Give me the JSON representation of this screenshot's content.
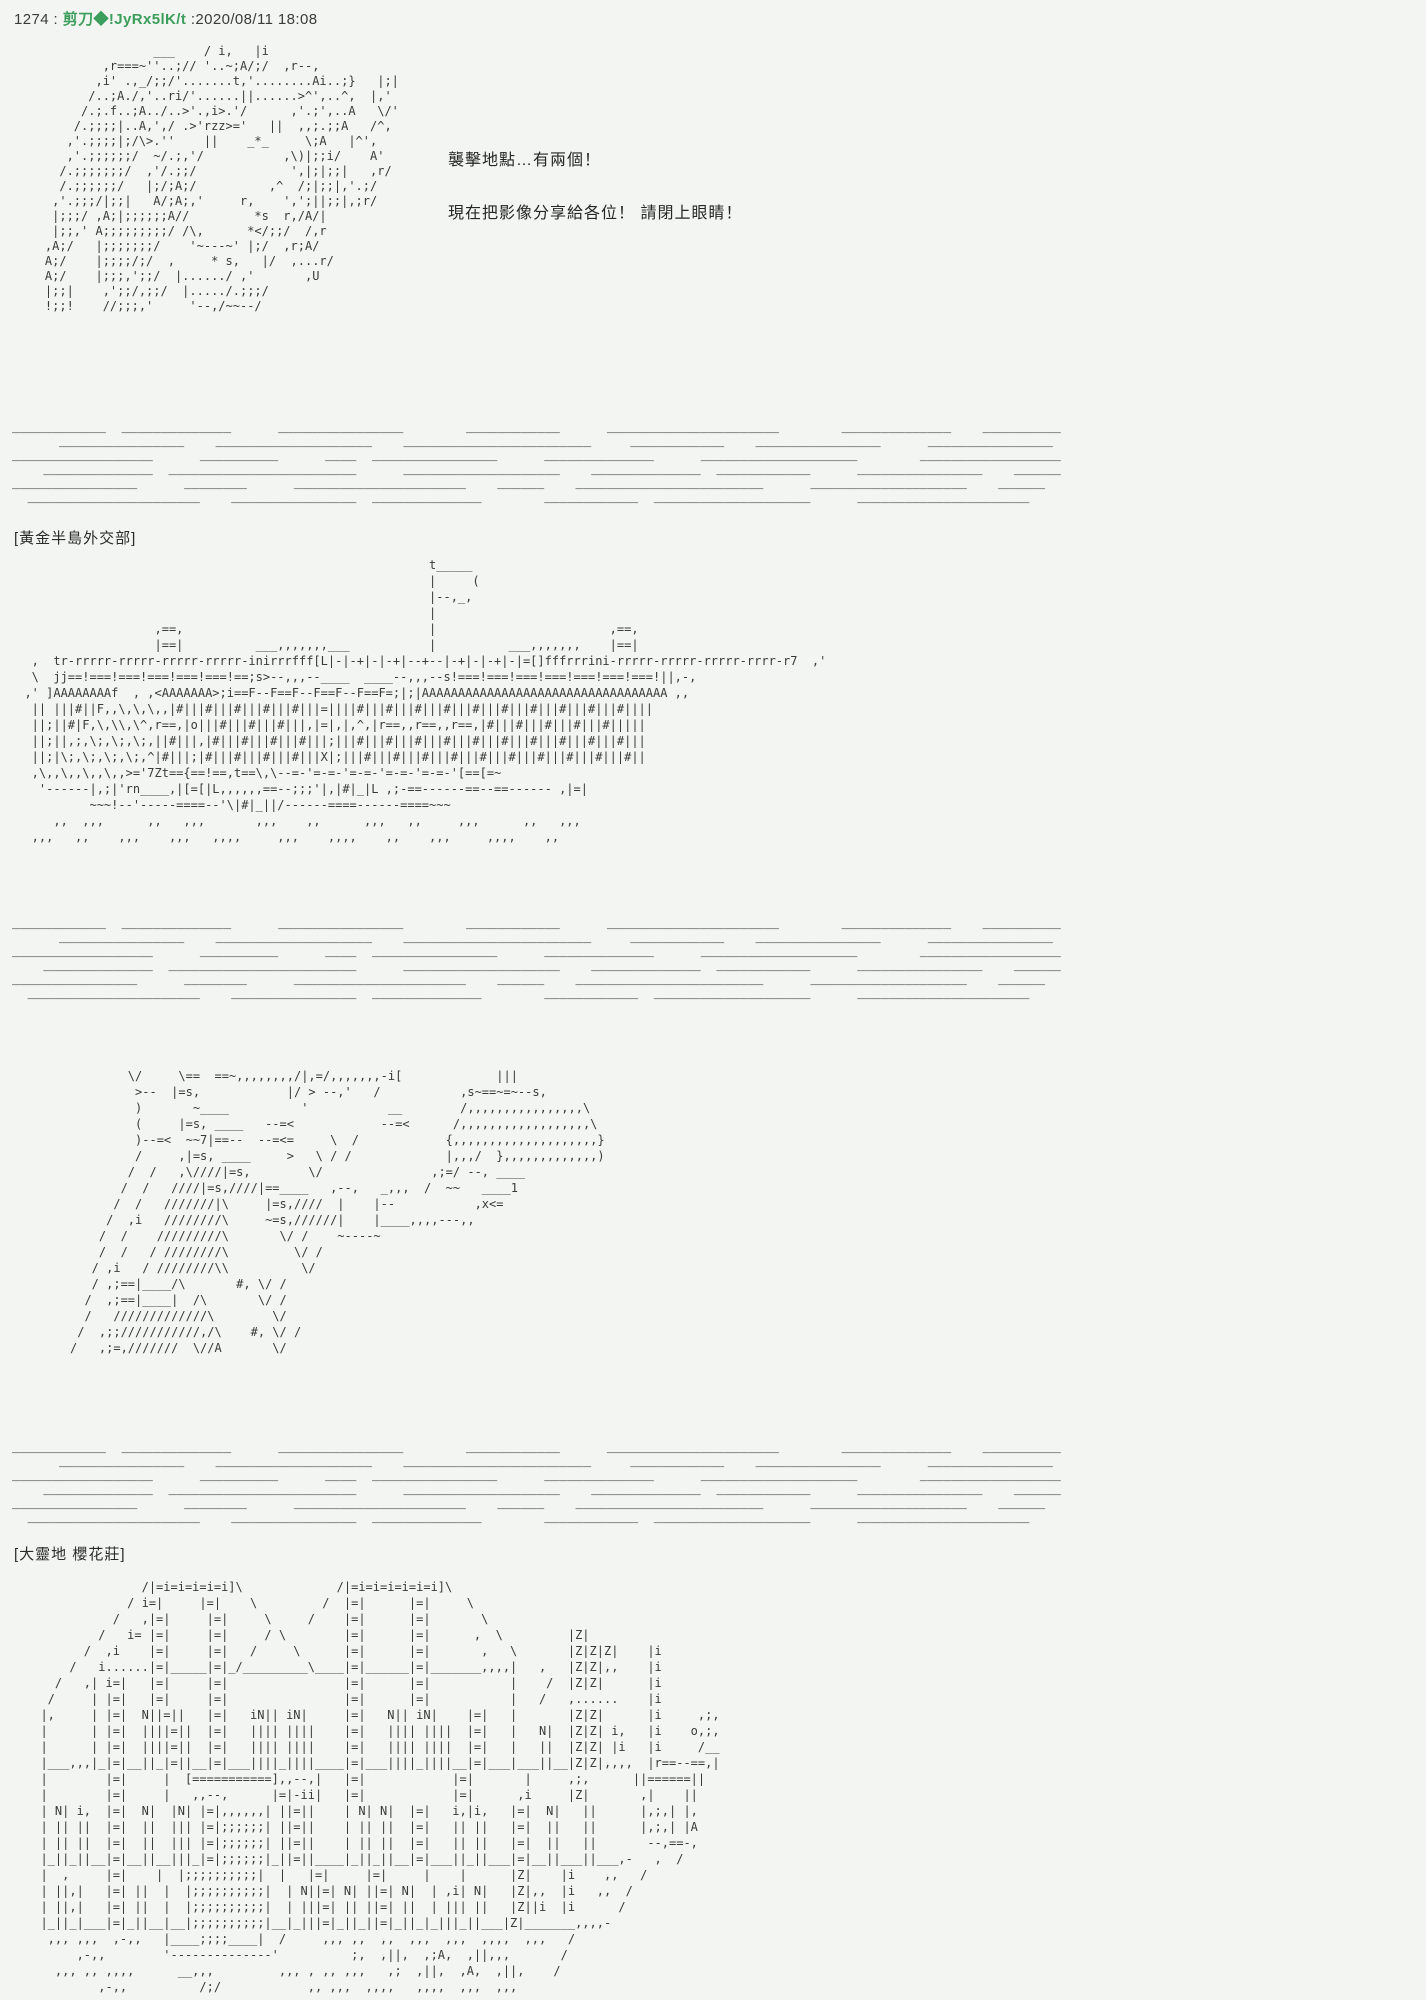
{
  "page": {
    "background_color": "#f2f5f1",
    "aa_text_color": "#3a3a3a",
    "poster_name_color": "#3c9e5d"
  },
  "post": {
    "number": "1274",
    "sep1": " : ",
    "name": "剪刀◆!JyRx5lK/t",
    "sep2": " :",
    "datetime": "2020/08/11 18:08"
  },
  "dialogue": {
    "line1": "襲擊地點…有兩個！",
    "line2": "現在把影像分享給各位！ 請閉上眼睛！"
  },
  "sections": {
    "label1": "[黃金半島外交部]",
    "label2": "[大靈地 櫻花莊]"
  },
  "aa": {
    "character1": [
      "                   ___    / i,   |i",
      "            ,r===~''..;// '..~;A/;/  ,r--,",
      "           ,i' .,_/;;/'.......t,'........Ai..;}   |;|",
      "          /..;A./,'..ri/'......||......>^',..^,  |,'",
      "         /.;.f..;A../..>'.,i>.'/      ,'.;',..A   \\/'",
      "        /.;;;;|..A,',/ .>'rzz>='   ||  ,,;.;;A   /^,",
      "       ,'.;;;;|;/\\>.''    ||    _*_     \\;A   |^',",
      "       ,'.;;;;;;/  ~/.;,'/           ,\\)|;;i/    A'",
      "      /.;;;;;;;/  ,'/.;;/             ',|;|;;|   ,r/",
      "      /.;;;;;;/   |;/;A;/          ,^  /;|;;|,'.;/",
      "     ,'.;;;/|;;|   A/;A;,'     r,    ',';||;;|,;r/",
      "     |;;;/ ,A;|;;;;;;A//         *s  r,/A/|",
      "     |;;,' A;;;;;;;;;/ /\\,      *</;;/  /,r",
      "    ,A;/   |;;;;;;;/    '~---~' |;/  ,r;A/",
      "    A;/    |;;;;/;/  ,     * s,   |/  ,...r/",
      "    A;/    |;;;,';;/  |....../ ,'       ,U",
      "    |;;|    ,';;/,;;/  |...../.;;;/",
      "    !;;!    //;;;,'     '--,/~~--/"
    ],
    "divider": [
      "____________  ______________      ________________        ____________      ______________________        ______________    __________",
      "      ________________    ____________________    ________________________     ____________    ________________      ________________",
      "__________________      __________      ____  ________________      ______________      ____________________        __________________",
      "    ______________  ________________________      ____________________    ______________  ____________      ________________    ______",
      "________________      ________      ______________________    ______    ________________________      ____________________    ______",
      "  ______________________    ________________  ______________        ____________  ____________________      ______________________"
    ],
    "building1": [
      "                                                          t_____",
      "                                                          |     (",
      "                                                          |--,_,",
      "                                                          |",
      "                    ,==,                                  |                        ,==,",
      "                    |==|          ___,,,,,,,___           |          ___,,,,,,,    |==|",
      "   ,  tr-rrrrr-rrrrr-rrrrr-rrrrr-inirrrfff[L|-|-+|-|-+|--+--|-+|-|-+|-|=[]fffrrrini-rrrrr-rrrrr-rrrrr-rrrr-r7  ,'",
      "   \\  jj==!===!===!===!===!===!==;s>--,,,--____  ____--,,,--s!===!===!===!===!===!===!===!||,-,",
      "  ,' ]AAAAAAAAf  , ,<AAAAAAA>;i==F--F==F--F==F--F==F=;|;|AAAAAAAAAAAAAAAAAAAAAAAAAAAAAAAAAA ,,",
      "   || |||#||F,,\\,\\,\\,,|#|||#|||#|||#|||#|||=||||#|||#|||#|||#|||#|||#|||#|||#|||#|||#||||",
      "   ||;||#|F,\\,\\\\,\\^,r==,|o|||#|||#|||#|||,|=|,|,^,|r==,,r==,,r==,|#|||#|||#|||#|||#|||||",
      "   ||;||,;,\\;,\\;,\\;,||#|||,|#|||#|||#|||#|||;|||#|||#|||#|||#|||#|||#|||#|||#|||#|||#|||",
      "   ||;|\\;,\\;,\\;,\\;,^|#|||;|#|||#|||#|||#|||X|;|||#|||#|||#|||#|||#|||#|||#|||#|||#|||#||",
      "   ,\\,,\\,,\\,,\\,,>='7Zt=={==!==,t==\\,\\--=-'=-=-'=-=-'=-=-'=-=-'[==[=~",
      "    '------|,;|'rn____,|[=[|L,,,,,,==--;;;'|,|#|_|L ,;-==------==--==------ ,|=|",
      "           ~~~!--'-----====--'\\|#|_||/------====------====~~~",
      "      ,,  ,,,      ,,   ,,,       ,,,    ,,      ,,,   ,,     ,,,      ,,   ,,,",
      "   ,,,   ,,    ,,,    ,,,   ,,,,     ,,,    ,,,,    ,,    ,,,     ,,,,    ,,"
    ],
    "character2": [
      "        \\/     \\==  ==~,,,,,,,,/|,=/,,,,,,,-i[             |||",
      "         >--  |=s,            |/ > --,'   /           ,s~==~=~--s,",
      "         )       ~____          '           __        /,,,,,,,,,,,,,,,,\\",
      "         (     |=s, ____   --=<            --=<      /,,,,,,,,,,,,,,,,,,\\",
      "         )--=<  ~~7|==--  --=<=     \\  /            {,,,,,,,,,,,,,,,,,,,,}",
      "         /     ,|=s, ____     >   \\ / /             |,,,/  },,,,,,,,,,,,,)",
      "        /  /   ,\\////|=s,        \\/               ,;=/ --, ____",
      "       /  /   ////|=s,////|==____   ,--,   _,,,  /  ~~   ____1",
      "      /  /   ///////|\\     |=s,////  |    |--           ,x<=",
      "     /  ,i   ////////\\     ~=s,//////|    |____,,,,---,,",
      "    /  /    /////////\\       \\/ /    ~----~",
      "    /  /   / ////////\\         \\/ /",
      "   / ,i   / ////////\\\\          \\/",
      "   / ,;==|____/\\       #, \\/ /",
      "  /  ,;==|____|  /\\       \\/ /",
      "  /   /////////////\\        \\/",
      " /  ,;;///////////,/\\    #, \\/ /",
      "/   ,;=,///////  \\//A       \\/"
    ],
    "building2": [
      "                /|=i=i=i=i=i]\\             /|=i=i=i=i=i=i]\\",
      "              / i=|     |=|    \\         /  |=|      |=|     \\",
      "            /   ,|=|     |=|     \\     /    |=|      |=|       \\",
      "          /   i= |=|     |=|     / \\        |=|      |=|      ,  \\         |Z|",
      "        /  ,i    |=|     |=|   /     \\      |=|      |=|       ,   \\       |Z|Z|Z|    |i",
      "      /   i......|=|_____|=|_/_________\\____|=|______|=|_______,,,,|   ,   |Z|Z|,,    |i",
      "    /   ,| i=|   |=|     |=|                |=|      |=|           |    /  |Z|Z|      |i",
      "   /     | |=|   |=|     |=|                |=|      |=|           |   /   ,......    |i",
      "  |,     | |=|  N||=||   |=|   iN|| iN|     |=|   N|| iN|    |=|   |       |Z|Z|      |i     ,;,",
      "  |      | |=|  ||||=||  |=|   |||| ||||    |=|   |||| ||||  |=|   |   N|  |Z|Z| i,   |i    o,;,",
      "  |      | |=|  ||||=||  |=|   |||| ||||    |=|   |||| ||||  |=|   |   ||  |Z|Z| |i   |i     /__",
      "  |___,,,|_|=|__||_|=||__|=|___||||_||||____|=|___||||_||||__|=|___|___||__|Z|Z|,,,,  |r==--==,|",
      "  |        |=|     |  [===========],,--,|   |=|            |=|       |     ,;,      ||======||",
      "  |        |=|     |   ,,--,      |=|-ii|   |=|            |=|      ,i     |Z|       ,|    ||",
      "  | N| i,  |=|  N|  |N| |=|,,,,,,| ||=||    | N| N|  |=|   i,|i,   |=|  N|   ||      |,;,| |,",
      "  | || ||  |=|  ||  ||| |=|;;;;;;| ||=||    | || ||  |=|   || ||   |=|  ||   ||      |,;,| |A",
      "  | || ||  |=|  ||  ||| |=|;;;;;;| ||=||    | || ||  |=|   || ||   |=|  ||   ||       --,==-,",
      "  |_||_||__|=|__||__|||_|=|;;;;;;|_||=||____|_||_||__|=|___||_||___|=|__||___||___,-   ,  /",
      "  |  ,     |=|    |  |;;;;;;;;;;|  |   |=|     |=|     |    |      |Z|    |i    ,,   /",
      "  | ||,|   |=| ||  |  |;;;;;;;;;;|  | N||=| N| ||=| N|  | ,i| N|   |Z|,,  |i   ,,  /",
      "  | ||,|   |=| ||  |  |;;;;;;;;;;|  | |||=| || ||=| ||  | ||| ||   |Z||i  |i      /",
      "  |_||_|___|=|_||__|__|;;;;;;;;;;|__|_|||=|_||_||=|_||_|_|||_||___|Z|_______,,,,-",
      "   ,,, ,,,  ,-,,   |____;;;;____|  /     ,,, ,,  ,,  ,,,  ,,,  ,,,,  ,,,   /",
      "       ,-,,        '--------------'          ;,  ,||,  ,;A,  ,||,,,       /",
      "    ,,, ,, ,,,,      __,,,         ,,, , ,, ,,,   ,;  ,||,  ,A,  ,||,    /",
      "          ,-,,          /;/            ,, ,,,  ,,,,   ,,,,  ,,,  ,,,"
    ]
  }
}
